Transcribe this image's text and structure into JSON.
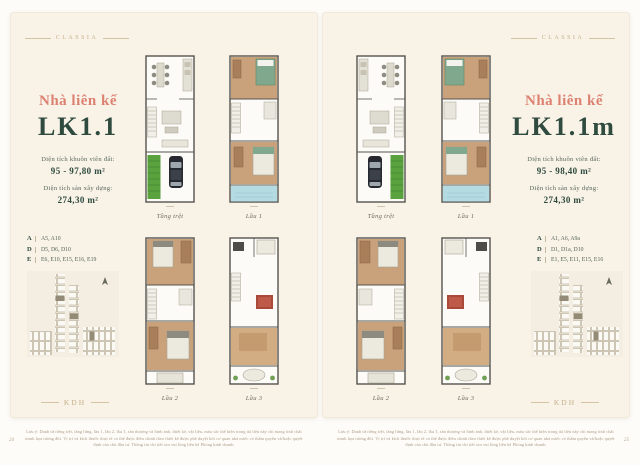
{
  "ornament_text": "CLASSIA",
  "footer_logo_text": "KDH",
  "disclaimer_text": "Lưu ý: Danh từ riêng trệt, tầng lửng, lầu 1, lầu 2, lầu 3, sân thượng và hình ảnh, thiết kế, vật liệu, màu sắc thể hiện trong tài liệu này chỉ mang tính chất minh họa tương đối. Vị trí và kích thước thực tế có thể được điều chỉnh theo thiết kế được phê duyệt bởi cơ quan nhà nước có thẩm quyền và/hoặc quyết định của chủ đầu tư. Thông tin chi tiết xin vui lòng liên hệ Phòng kinh doanh.",
  "colors": {
    "accent_salmon": "#dd8272",
    "accent_green": "#2f4a3e",
    "gold": "#c6b18a",
    "page_background": "#f8f2e7"
  },
  "pages": [
    {
      "title": "Nhà liên kế",
      "code": "LK1.1",
      "land_area_label": "Diện tích khuôn viên đất:",
      "land_area_value": "95 - 97,80 m²",
      "gfa_label": "Diện tích sàn xây dựng:",
      "gfa_value": "274,30 m²",
      "legend": [
        {
          "key": "A",
          "value": "A5, A10"
        },
        {
          "key": "D",
          "value": "D5, D6, D10"
        },
        {
          "key": "E",
          "value": "E6, E10, E15, E16, E19"
        }
      ],
      "plans": [
        {
          "caption": "Tầng trệt"
        },
        {
          "caption": "Lầu 1"
        },
        {
          "caption": "Lầu 2"
        },
        {
          "caption": "Lầu 3"
        }
      ],
      "page_number": "24"
    },
    {
      "title": "Nhà liên kế",
      "code": "LK1.1m",
      "land_area_label": "Diện tích khuôn viên đất:",
      "land_area_value": "95 - 98,40 m²",
      "gfa_label": "Diện tích sàn xây dựng:",
      "gfa_value": "274,30 m²",
      "legend": [
        {
          "key": "A",
          "value": "A1, A6, A9a"
        },
        {
          "key": "D",
          "value": "D1, D1a, D10"
        },
        {
          "key": "E",
          "value": "E1, E5, E11, E15, E16"
        }
      ],
      "plans": [
        {
          "caption": "Tầng trệt"
        },
        {
          "caption": "Lầu 1"
        },
        {
          "caption": "Lầu 2"
        },
        {
          "caption": "Lầu 3"
        }
      ],
      "page_number": "25"
    }
  ]
}
